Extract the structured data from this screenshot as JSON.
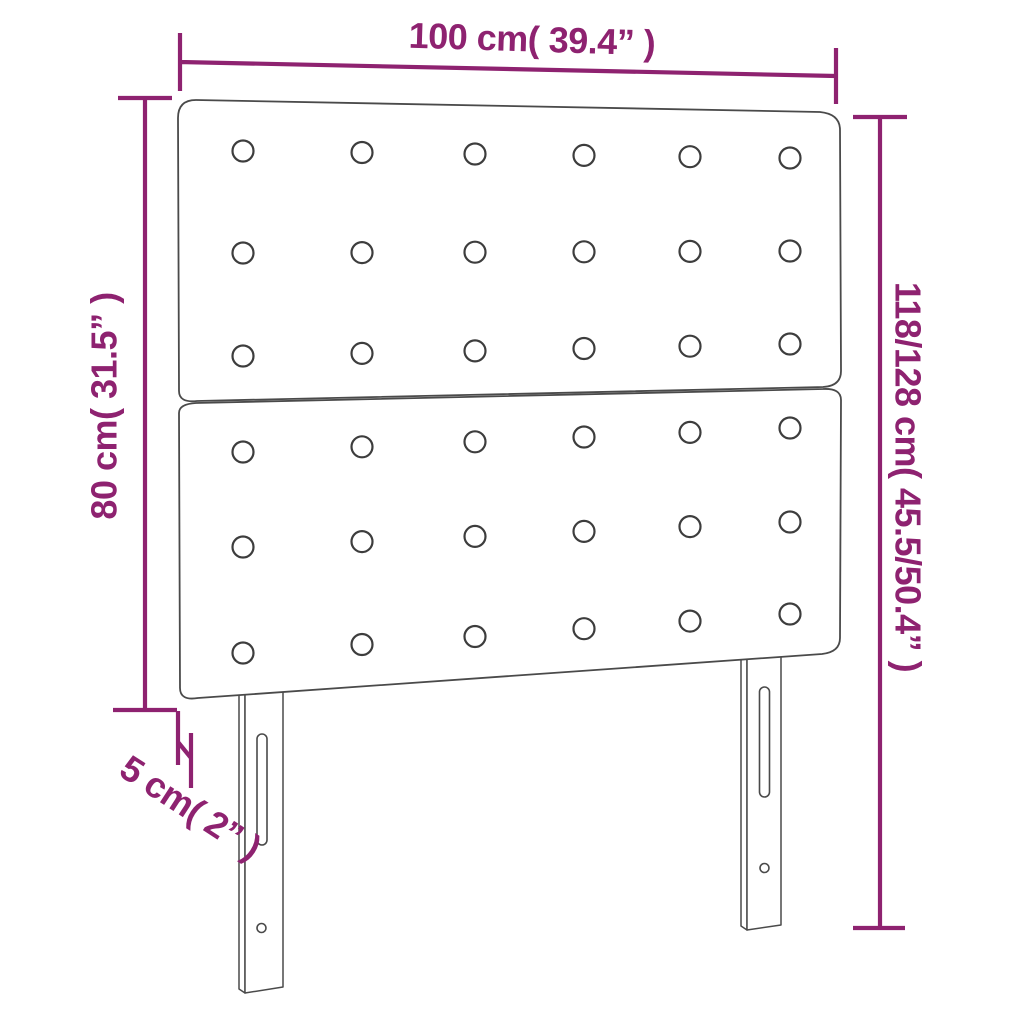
{
  "title": "Headboard dimension diagram",
  "product": "upholstered headboard with 2 panels, tufted buttons and 2 adjustable legs",
  "labels": {
    "width": "100 cm( 39.4” )",
    "board_height": "80 cm( 31.5” )",
    "total_height": "118/128 cm( 45.5/50.4” )",
    "thickness": "5 cm( 2” )"
  },
  "tufting": {
    "panels": 2,
    "rows_per_panel": 3,
    "columns": 6
  },
  "colors": {
    "dimension": "#8e2270",
    "outline": "#4a4a4a",
    "background": "#ffffff"
  }
}
